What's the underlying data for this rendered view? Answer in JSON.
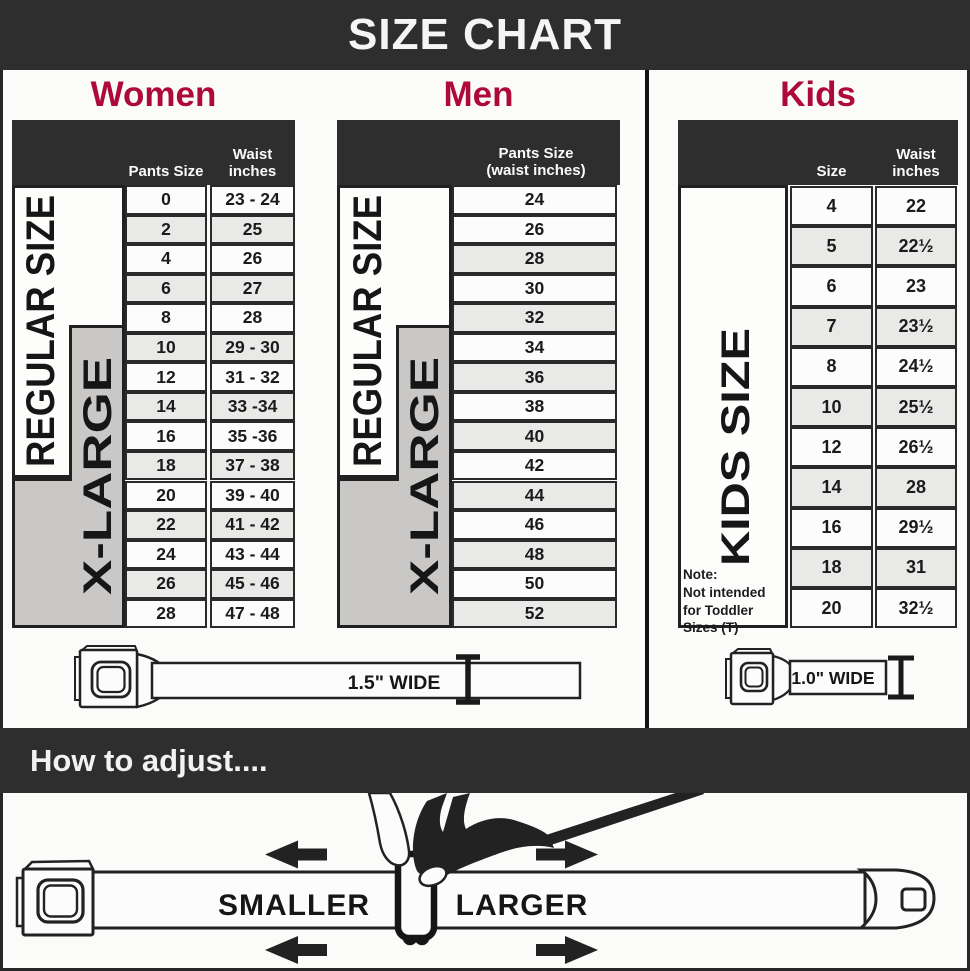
{
  "title": "SIZE CHART",
  "colors": {
    "bar": "#2e2e2e",
    "accent": "#ad0a3a",
    "xlarge_band": "#c9c8c7",
    "row_alt": "#e9e9e8",
    "border": "#262626"
  },
  "sections": {
    "women": {
      "heading": "Women",
      "size_header": "Pants Size",
      "waist_header": "Waist inches",
      "regular_label": "REGULAR SIZE",
      "xlarge_label": "X-LARGE",
      "rows": [
        {
          "size": "0",
          "waist": "23 - 24"
        },
        {
          "size": "2",
          "waist": "25"
        },
        {
          "size": "4",
          "waist": "26"
        },
        {
          "size": "6",
          "waist": "27"
        },
        {
          "size": "8",
          "waist": "28"
        },
        {
          "size": "10",
          "waist": "29 - 30"
        },
        {
          "size": "12",
          "waist": "31 - 32"
        },
        {
          "size": "14",
          "waist": "33 -34"
        },
        {
          "size": "16",
          "waist": "35 -36"
        },
        {
          "size": "18",
          "waist": "37 - 38"
        },
        {
          "size": "20",
          "waist": "39 - 40"
        },
        {
          "size": "22",
          "waist": "41 - 42"
        },
        {
          "size": "24",
          "waist": "43 - 44"
        },
        {
          "size": "26",
          "waist": "45 - 46"
        },
        {
          "size": "28",
          "waist": "47 - 48"
        }
      ]
    },
    "men": {
      "heading": "Men",
      "col_header": [
        "Pants Size",
        "(waist inches)"
      ],
      "regular_label": "REGULAR SIZE",
      "xlarge_label": "X-LARGE",
      "rows": [
        "24",
        "26",
        "28",
        "30",
        "32",
        "34",
        "36",
        "38",
        "40",
        "42",
        "44",
        "46",
        "48",
        "50",
        "52"
      ]
    },
    "kids": {
      "heading": "Kids",
      "size_header": "Size",
      "waist_header": "Waist inches",
      "side_label": "KIDS SIZE",
      "note_title": "Note:",
      "note_body": "Not intended for Toddler Sizes (T)",
      "rows": [
        {
          "size": "4",
          "waist": "22"
        },
        {
          "size": "5",
          "waist": "22½"
        },
        {
          "size": "6",
          "waist": "23"
        },
        {
          "size": "7",
          "waist": "23½"
        },
        {
          "size": "8",
          "waist": "24½"
        },
        {
          "size": "10",
          "waist": "25½"
        },
        {
          "size": "12",
          "waist": "26½"
        },
        {
          "size": "14",
          "waist": "28"
        },
        {
          "size": "16",
          "waist": "29½"
        },
        {
          "size": "18",
          "waist": "31"
        },
        {
          "size": "20",
          "waist": "32½"
        }
      ]
    }
  },
  "belts": {
    "adult_label": "1.5\" WIDE",
    "kids_label": "1.0\" WIDE"
  },
  "adjust": {
    "heading": "How to adjust....",
    "smaller": "SMALLER",
    "larger": "LARGER"
  }
}
